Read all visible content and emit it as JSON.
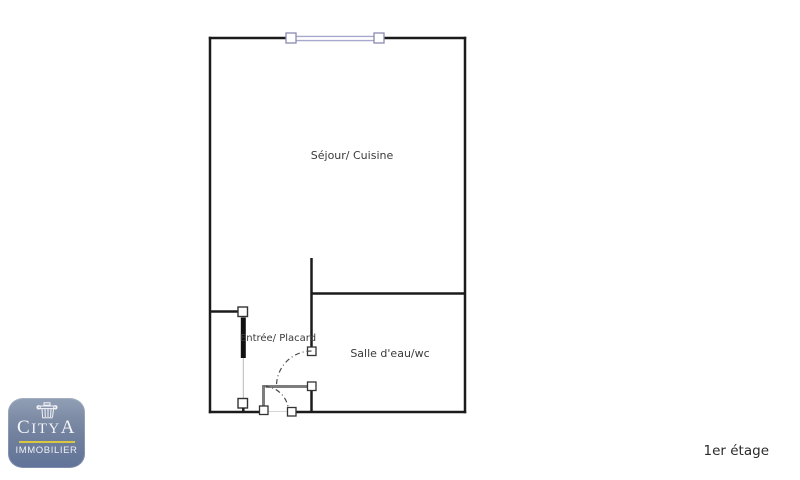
{
  "plan": {
    "rooms": [
      {
        "id": "sejour-cuisine",
        "label": "Séjour/ Cuisine"
      },
      {
        "id": "entree-placard",
        "label": "Entrée/ Placard"
      },
      {
        "id": "salle-eau-wc",
        "label": "Salle d'eau/wc"
      }
    ],
    "floor_label": "1er étage"
  },
  "logo": {
    "brand_parts": [
      "C",
      "ITY",
      "A"
    ],
    "tagline": "IMMOBILIER",
    "icon": "column-capital-icon",
    "colors": {
      "background_top": "#92a0b6",
      "background_bottom": "#617399",
      "accent_line": "#d9c83f",
      "text": "#f4f5f9"
    }
  },
  "colors": {
    "wall": "#1b1b1b",
    "window": "#a8a8cc",
    "door_leaf": "#7d7d7d",
    "swing_arc": "#4a4a4a",
    "label_text": "#3a3a3a",
    "background": "#ffffff"
  }
}
